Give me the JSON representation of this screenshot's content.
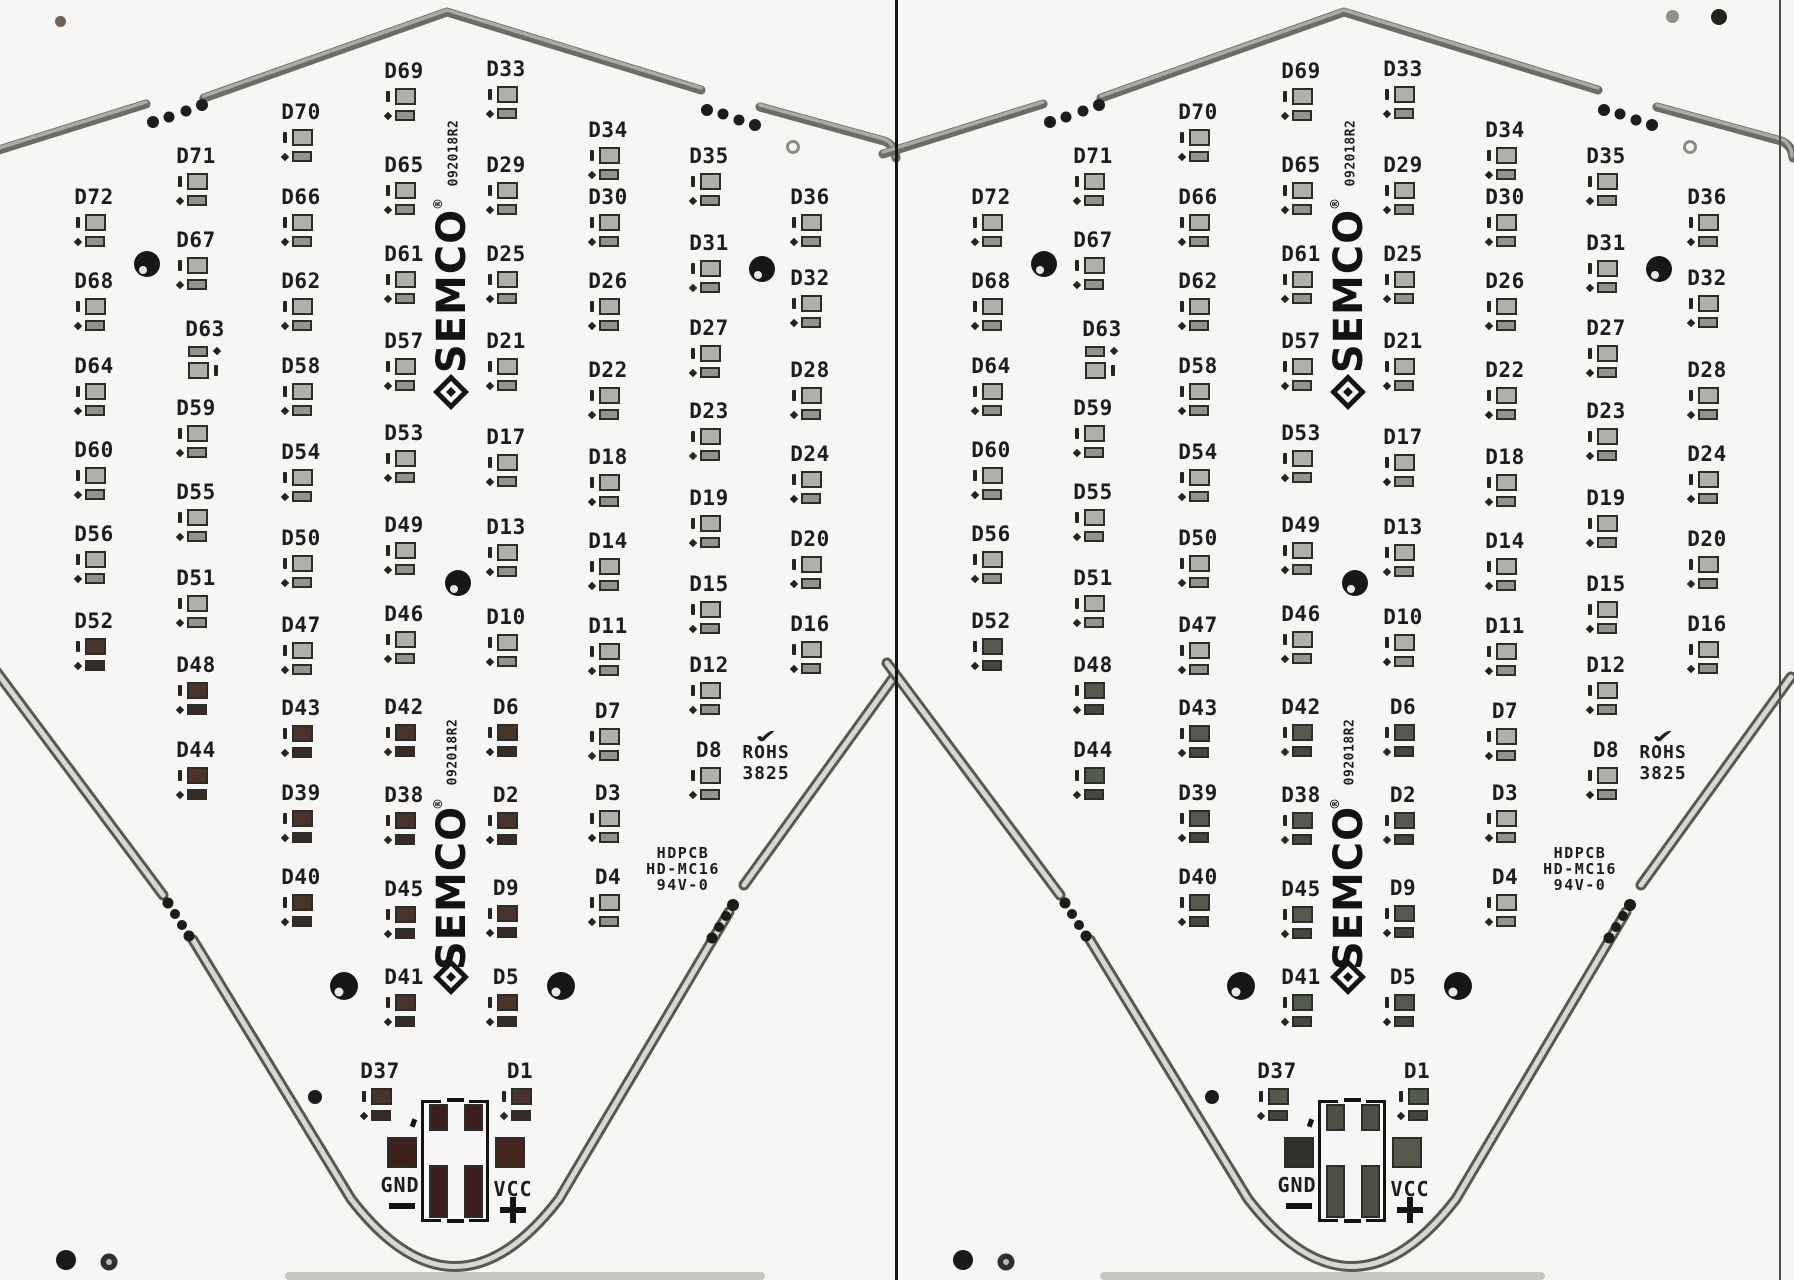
{
  "board": {
    "brand_word": "SEMCO",
    "reg_mark": "®",
    "serial": "092018R2",
    "rohs": {
      "check": "✔",
      "line1": "ROHS",
      "line2": "3825"
    },
    "part": {
      "line1": "HDPCB",
      "line2": "HD-MC16",
      "line3": "94V-0"
    },
    "power": {
      "gnd_label": "GND",
      "gnd_sign": "−",
      "vcc_label": "VCC",
      "vcc_sign": "+"
    },
    "colors": {
      "silkscreen": "#1d1d1b",
      "pad_gray_top": "#b0b0ab",
      "pad_gray_bottom": "#94948f",
      "edge_dark": "#6b6b68",
      "edge_light": "#abaaa7",
      "bottom_edge_dark": "#585751",
      "bottom_edge_light": "#d8d7d4",
      "hole": "#171715",
      "divider": "#151513"
    },
    "dark_leds": [
      "D52",
      "D48",
      "D44",
      "D43",
      "D42",
      "D39",
      "D40",
      "D38",
      "D45",
      "D41",
      "D37",
      "D6",
      "D2",
      "D9",
      "D5",
      "D1"
    ],
    "leds": [
      {
        "id": "D72",
        "x": 94,
        "y": 197
      },
      {
        "id": "D68",
        "x": 94,
        "y": 281
      },
      {
        "id": "D64",
        "x": 94,
        "y": 366
      },
      {
        "id": "D60",
        "x": 94,
        "y": 450
      },
      {
        "id": "D56",
        "x": 94,
        "y": 534
      },
      {
        "id": "D52",
        "x": 94,
        "y": 621
      },
      {
        "id": "D71",
        "x": 196,
        "y": 156
      },
      {
        "id": "D67",
        "x": 196,
        "y": 240
      },
      {
        "id": "D63",
        "x": 205,
        "y": 329,
        "variant": "mirror"
      },
      {
        "id": "D59",
        "x": 196,
        "y": 408
      },
      {
        "id": "D55",
        "x": 196,
        "y": 492
      },
      {
        "id": "D51",
        "x": 196,
        "y": 578
      },
      {
        "id": "D48",
        "x": 196,
        "y": 665
      },
      {
        "id": "D44",
        "x": 196,
        "y": 750
      },
      {
        "id": "D70",
        "x": 301,
        "y": 112
      },
      {
        "id": "D66",
        "x": 301,
        "y": 197
      },
      {
        "id": "D62",
        "x": 301,
        "y": 281
      },
      {
        "id": "D58",
        "x": 301,
        "y": 366
      },
      {
        "id": "D54",
        "x": 301,
        "y": 452
      },
      {
        "id": "D50",
        "x": 301,
        "y": 538
      },
      {
        "id": "D47",
        "x": 301,
        "y": 625
      },
      {
        "id": "D43",
        "x": 301,
        "y": 708
      },
      {
        "id": "D39",
        "x": 301,
        "y": 793
      },
      {
        "id": "D40",
        "x": 301,
        "y": 877
      },
      {
        "id": "D69",
        "x": 404,
        "y": 71
      },
      {
        "id": "D65",
        "x": 404,
        "y": 165
      },
      {
        "id": "D61",
        "x": 404,
        "y": 254
      },
      {
        "id": "D57",
        "x": 404,
        "y": 341
      },
      {
        "id": "D53",
        "x": 404,
        "y": 433
      },
      {
        "id": "D49",
        "x": 404,
        "y": 525
      },
      {
        "id": "D46",
        "x": 404,
        "y": 614
      },
      {
        "id": "D42",
        "x": 404,
        "y": 707
      },
      {
        "id": "D38",
        "x": 404,
        "y": 795
      },
      {
        "id": "D45",
        "x": 404,
        "y": 889
      },
      {
        "id": "D41",
        "x": 404,
        "y": 977
      },
      {
        "id": "D37",
        "x": 380,
        "y": 1071
      },
      {
        "id": "D33",
        "x": 506,
        "y": 69
      },
      {
        "id": "D29",
        "x": 506,
        "y": 165
      },
      {
        "id": "D25",
        "x": 506,
        "y": 254
      },
      {
        "id": "D21",
        "x": 506,
        "y": 341
      },
      {
        "id": "D17",
        "x": 506,
        "y": 437
      },
      {
        "id": "D13",
        "x": 506,
        "y": 527
      },
      {
        "id": "D10",
        "x": 506,
        "y": 617
      },
      {
        "id": "D6",
        "x": 506,
        "y": 707
      },
      {
        "id": "D2",
        "x": 506,
        "y": 795
      },
      {
        "id": "D9",
        "x": 506,
        "y": 888
      },
      {
        "id": "D5",
        "x": 506,
        "y": 977
      },
      {
        "id": "D1",
        "x": 520,
        "y": 1071
      },
      {
        "id": "D34",
        "x": 608,
        "y": 130
      },
      {
        "id": "D30",
        "x": 608,
        "y": 197
      },
      {
        "id": "D26",
        "x": 608,
        "y": 281
      },
      {
        "id": "D22",
        "x": 608,
        "y": 370
      },
      {
        "id": "D18",
        "x": 608,
        "y": 457
      },
      {
        "id": "D14",
        "x": 608,
        "y": 541
      },
      {
        "id": "D11",
        "x": 608,
        "y": 626
      },
      {
        "id": "D7",
        "x": 608,
        "y": 711
      },
      {
        "id": "D3",
        "x": 608,
        "y": 793
      },
      {
        "id": "D4",
        "x": 608,
        "y": 877
      },
      {
        "id": "D35",
        "x": 709,
        "y": 156
      },
      {
        "id": "D31",
        "x": 709,
        "y": 243
      },
      {
        "id": "D27",
        "x": 709,
        "y": 328
      },
      {
        "id": "D23",
        "x": 709,
        "y": 411
      },
      {
        "id": "D19",
        "x": 709,
        "y": 498
      },
      {
        "id": "D15",
        "x": 709,
        "y": 584
      },
      {
        "id": "D12",
        "x": 709,
        "y": 665
      },
      {
        "id": "D8",
        "x": 709,
        "y": 750
      },
      {
        "id": "D36",
        "x": 810,
        "y": 197
      },
      {
        "id": "D32",
        "x": 810,
        "y": 278
      },
      {
        "id": "D28",
        "x": 810,
        "y": 370
      },
      {
        "id": "D24",
        "x": 810,
        "y": 454
      },
      {
        "id": "D20",
        "x": 810,
        "y": 539
      },
      {
        "id": "D16",
        "x": 810,
        "y": 624
      }
    ],
    "panels": [
      {
        "side": "left",
        "x": 0,
        "dark": {
          "p1": "#4a332b",
          "p2": "#392a24",
          "gnd": "#3e211c",
          "vcc": "#45251e",
          "box": "#3c1f1a"
        }
      },
      {
        "side": "right",
        "x": 897,
        "dark": {
          "p1": "#555a4e",
          "p2": "#44483e",
          "gnd": "#2f312c",
          "vcc": "#555a4b",
          "box": "#4c5044"
        }
      }
    ]
  }
}
